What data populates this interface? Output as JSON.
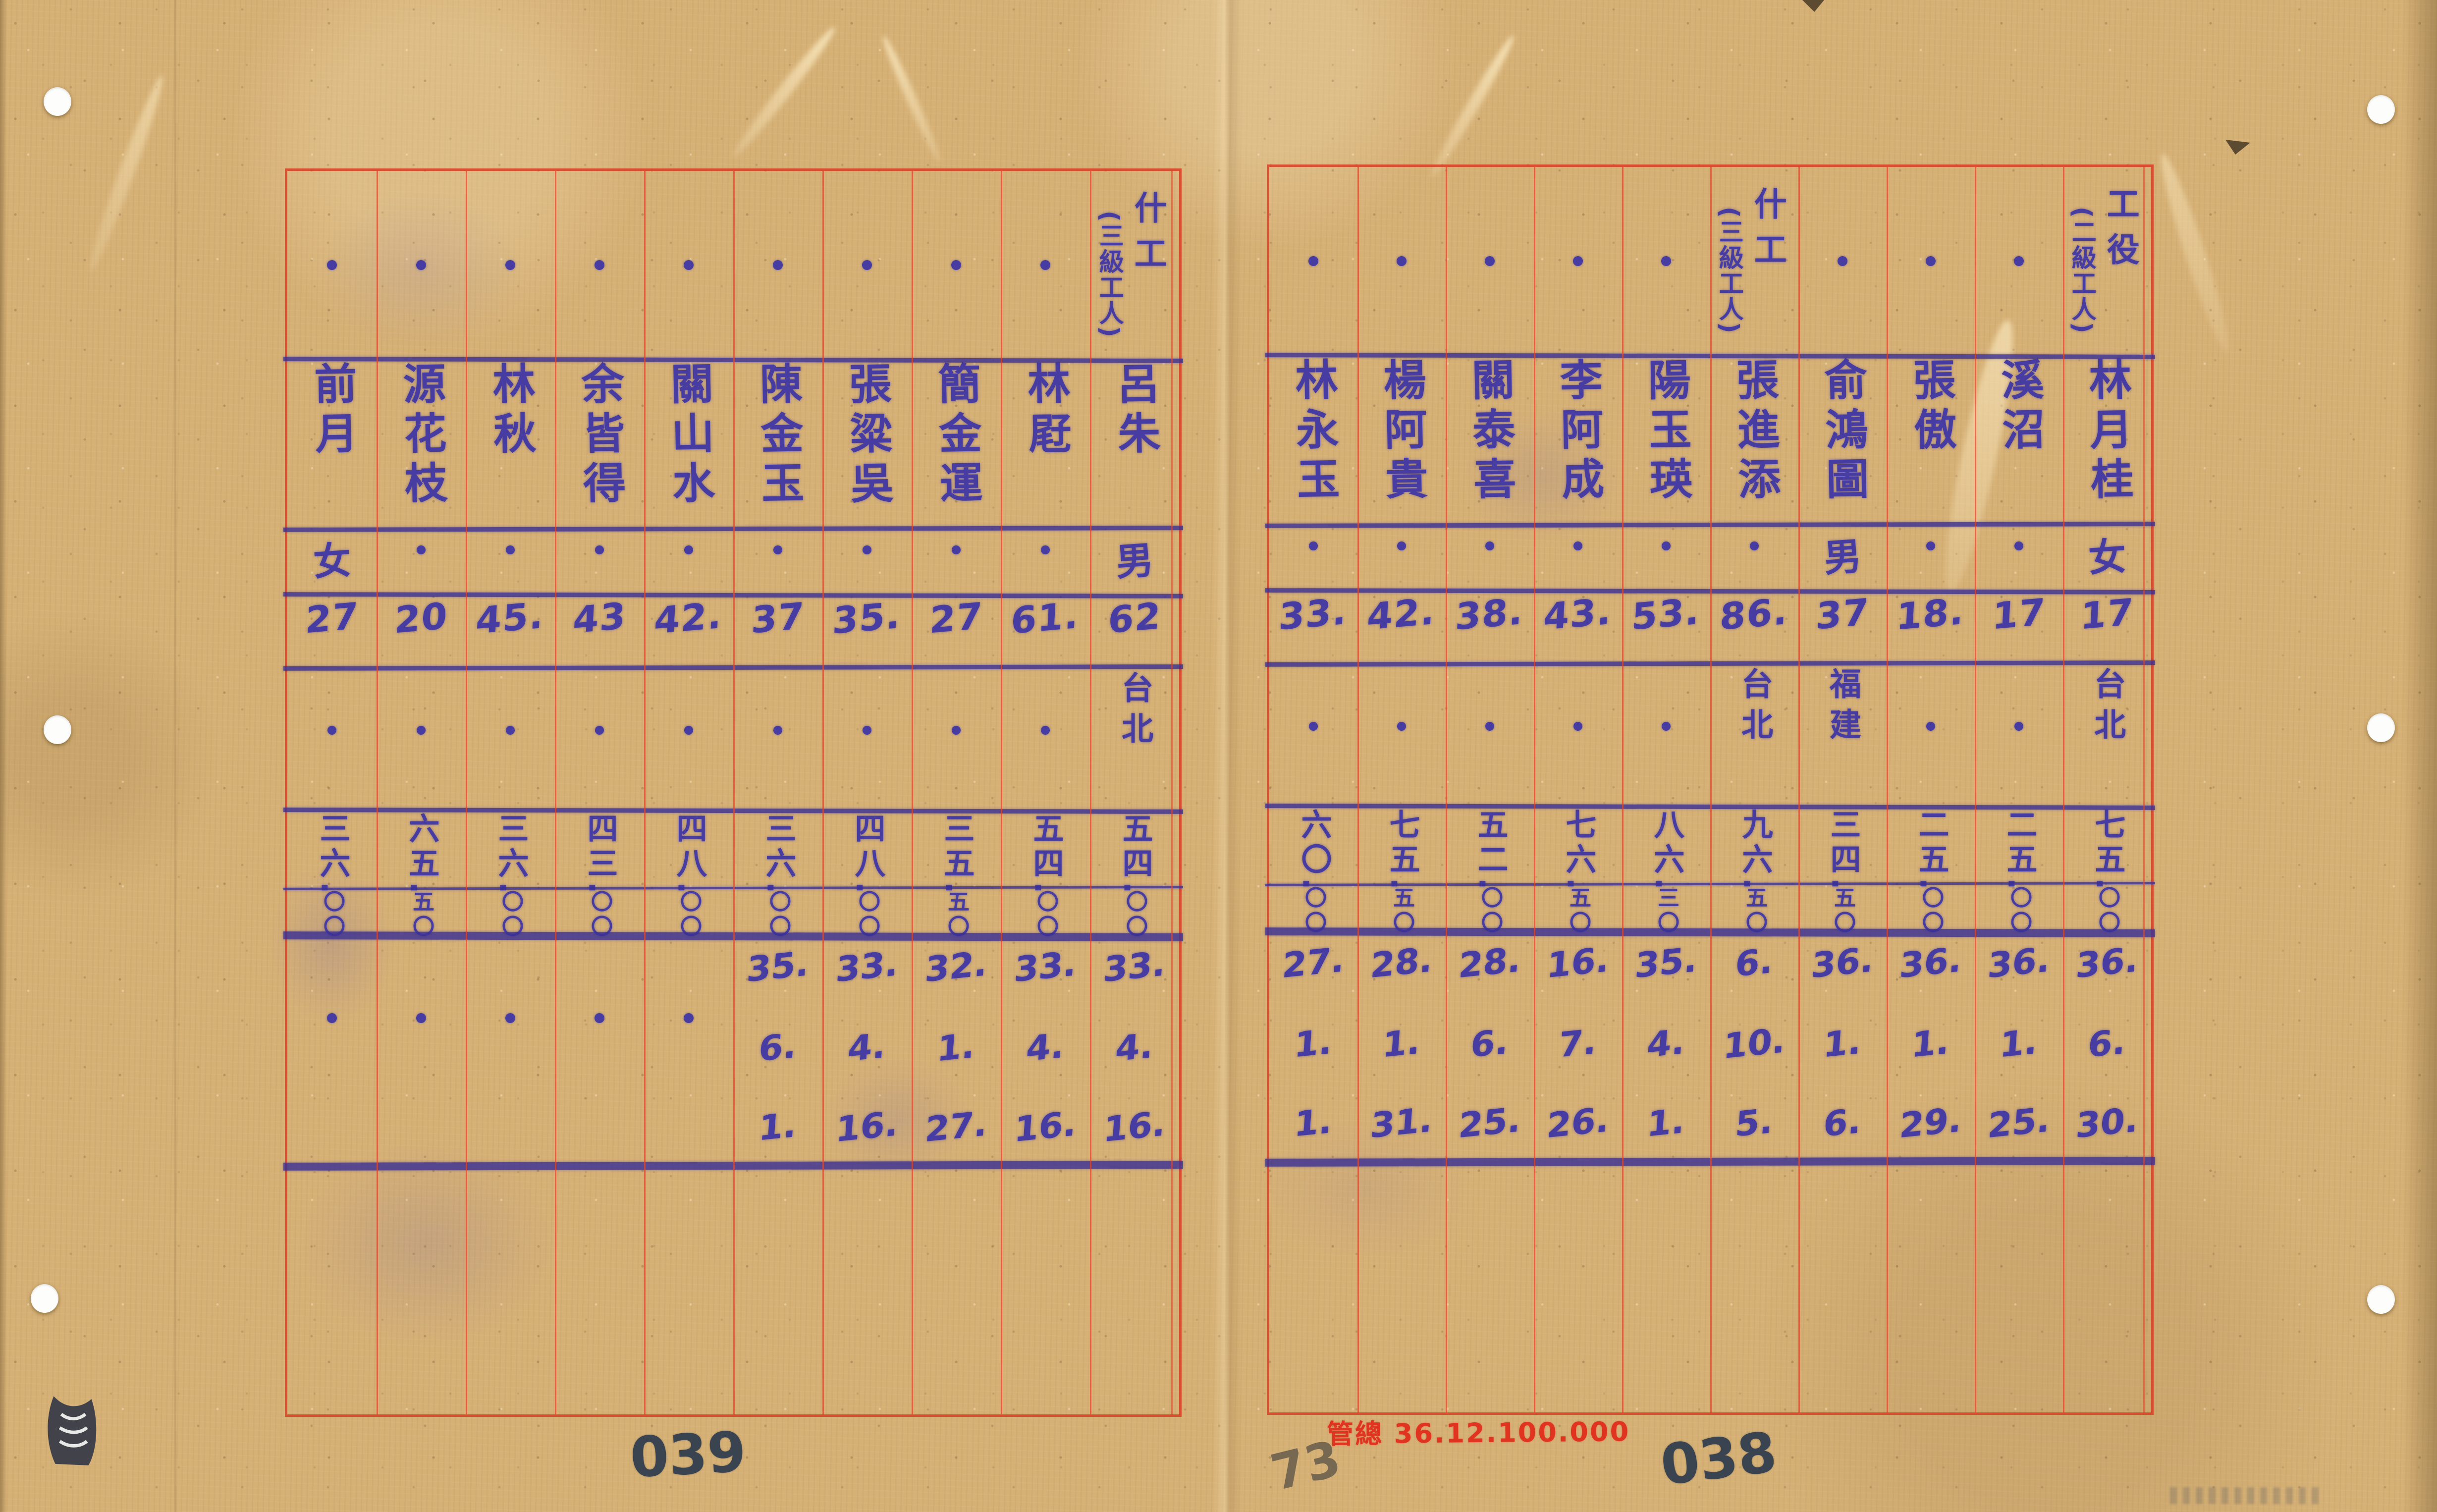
{
  "document": {
    "kind": "scanned handwritten personnel roster (two facing pages, vertical Chinese script)",
    "stamp": "管總 36.12.100.000",
    "page_number_left": "039",
    "page_number_right": "038",
    "pencil_number": "73",
    "ditto_mark": "・"
  },
  "icons": {
    "archive_logo": "dark-book-emblem"
  },
  "colors": {
    "paper": "#d6b176",
    "grid_red": "#de4a2c",
    "ink_blue": "#473ca2",
    "stamp_red": "#e03420",
    "page_ink": "#3a4450",
    "pencil_gray": "#6c614e"
  },
  "pages": [
    {
      "side": "left",
      "page_label": "039",
      "columns": [
        {
          "job": null,
          "name": "前月",
          "gender": "女",
          "age": "27",
          "origin": null,
          "wage": "三六.",
          "wage_sub": "〇〇",
          "date": null
        },
        {
          "job": null,
          "name": "源花枝",
          "gender": null,
          "age": "20",
          "origin": null,
          "wage": "六五.",
          "wage_sub": "五〇",
          "date": null
        },
        {
          "job": null,
          "name": "林秋",
          "gender": null,
          "age": "45.",
          "origin": null,
          "wage": "三六.",
          "wage_sub": "〇〇",
          "date": null
        },
        {
          "job": null,
          "name": "余皆得",
          "gender": null,
          "age": "43",
          "origin": null,
          "wage": "四三.",
          "wage_sub": "〇〇",
          "date": null
        },
        {
          "job": null,
          "name": "關山水",
          "gender": null,
          "age": "42.",
          "origin": null,
          "wage": "四八.",
          "wage_sub": "〇〇",
          "date": null
        },
        {
          "job": null,
          "name": "陳金玉",
          "gender": null,
          "age": "37",
          "origin": null,
          "wage": "三六.",
          "wage_sub": "〇〇",
          "date": [
            "35.",
            "6.",
            "1."
          ]
        },
        {
          "job": null,
          "name": "張粱吳",
          "gender": null,
          "age": "35.",
          "origin": null,
          "wage": "四八.",
          "wage_sub": "〇〇",
          "date": [
            "33.",
            "4.",
            "16."
          ]
        },
        {
          "job": null,
          "name": "簡金運",
          "gender": null,
          "age": "27",
          "origin": null,
          "wage": "三五.",
          "wage_sub": "五〇",
          "date": [
            "32.",
            "1.",
            "27."
          ]
        },
        {
          "job": null,
          "name": "林屘",
          "gender": null,
          "age": "61.",
          "origin": null,
          "wage": "五四.",
          "wage_sub": "〇〇",
          "date": [
            "33.",
            "4.",
            "16."
          ]
        },
        {
          "job": "什工",
          "job_paren": "(三級工人)",
          "name": "呂朱",
          "gender": "男",
          "age": "62",
          "origin": "台北",
          "wage": "五四.",
          "wage_sub": "〇〇",
          "date": [
            "33.",
            "4.",
            "16."
          ]
        }
      ]
    },
    {
      "side": "right",
      "page_label": "038",
      "columns": [
        {
          "job": null,
          "name": "林永玉",
          "gender": null,
          "age": "33.",
          "origin": null,
          "wage": "六〇.",
          "wage_sub": "〇〇",
          "date": [
            "27.",
            "1.",
            "1."
          ]
        },
        {
          "job": null,
          "name": "楊阿貴",
          "gender": null,
          "age": "42.",
          "origin": null,
          "wage": "七五.",
          "wage_sub": "五〇",
          "date": [
            "28.",
            "1.",
            "31."
          ]
        },
        {
          "job": null,
          "name": "關泰喜",
          "gender": null,
          "age": "38.",
          "origin": null,
          "wage": "五二.",
          "wage_sub": "〇〇",
          "date": [
            "28.",
            "6.",
            "25."
          ]
        },
        {
          "job": null,
          "name": "李阿成",
          "gender": null,
          "age": "43.",
          "origin": null,
          "wage": "七六.",
          "wage_sub": "五〇",
          "date": [
            "16.",
            "7.",
            "26."
          ]
        },
        {
          "job": null,
          "name": "陽玉瑛",
          "gender": null,
          "age": "53.",
          "origin": null,
          "wage": "八六.",
          "wage_sub": "三〇",
          "date": [
            "35.",
            "4.",
            "1."
          ]
        },
        {
          "job": "什工",
          "job_paren": "(三級工人)",
          "name": "張進添",
          "gender": null,
          "age": "86.",
          "origin": "台北",
          "wage": "九六.",
          "wage_sub": "五〇",
          "date": [
            "6.",
            "10.",
            "5."
          ]
        },
        {
          "job": null,
          "name": "俞鴻圖",
          "gender": "男",
          "age": "37",
          "origin": "福建",
          "wage": "三四.",
          "wage_sub": "五〇",
          "date": [
            "36.",
            "1.",
            "6."
          ]
        },
        {
          "job": null,
          "name": "張傲",
          "gender": null,
          "age": "18.",
          "origin": null,
          "wage": "二五.",
          "wage_sub": "〇〇",
          "date": [
            "36.",
            "1.",
            "29."
          ]
        },
        {
          "job": null,
          "name": "溪沼",
          "gender": null,
          "age": "17",
          "origin": null,
          "wage": "二五.",
          "wage_sub": "〇〇",
          "date": [
            "36.",
            "1.",
            "25."
          ]
        },
        {
          "job": "工役",
          "job_paren": "(二級工人)",
          "name": "林月桂",
          "gender": "女",
          "age": "17",
          "origin": "台北",
          "wage": "七五.",
          "wage_sub": "〇〇",
          "date": [
            "36.",
            "6.",
            "30."
          ]
        }
      ]
    }
  ]
}
